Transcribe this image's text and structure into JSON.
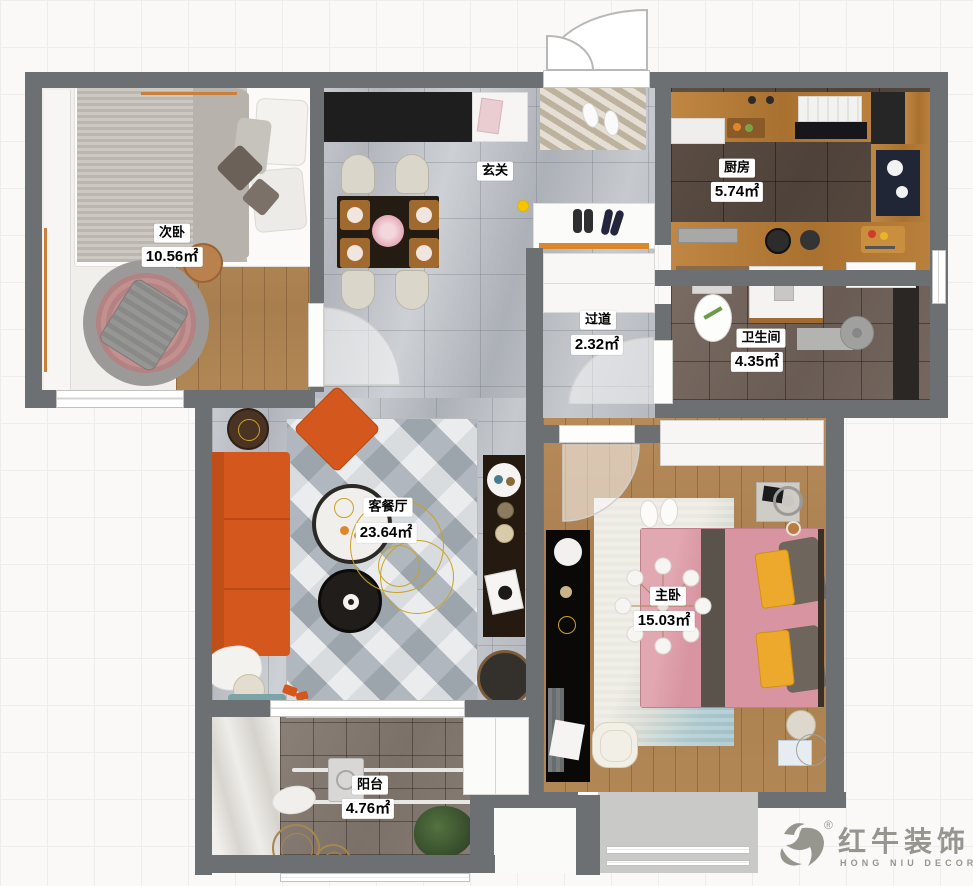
{
  "canvas": {
    "width": 973,
    "height": 886
  },
  "rooms": [
    {
      "id": "secondary-bedroom",
      "name": "次卧",
      "area": "10.56㎡"
    },
    {
      "id": "entryway",
      "name": "玄关",
      "area": ""
    },
    {
      "id": "kitchen",
      "name": "厨房",
      "area": "5.74㎡"
    },
    {
      "id": "hallway",
      "name": "过道",
      "area": "2.32㎡"
    },
    {
      "id": "bathroom",
      "name": "卫生间",
      "area": "4.35㎡"
    },
    {
      "id": "living-dining",
      "name": "客餐厅",
      "area": "23.64㎡"
    },
    {
      "id": "master-bedroom",
      "name": "主卧",
      "area": "15.03㎡"
    },
    {
      "id": "balcony",
      "name": "阳台",
      "area": "4.76㎡"
    }
  ],
  "logo": {
    "registered": "®",
    "brand": "红牛装饰",
    "subtitle": "HONG NIU DECORATION"
  },
  "colors": {
    "wall": "#6d7073",
    "sofa_orange": "#d4571e",
    "master_bed_pink": "#d895a1",
    "pillow_yellow": "#eda92c",
    "cabinet_wood": "#b9813e",
    "logo_gray": "#96968f",
    "indicator_yellow": "#f6c500"
  }
}
